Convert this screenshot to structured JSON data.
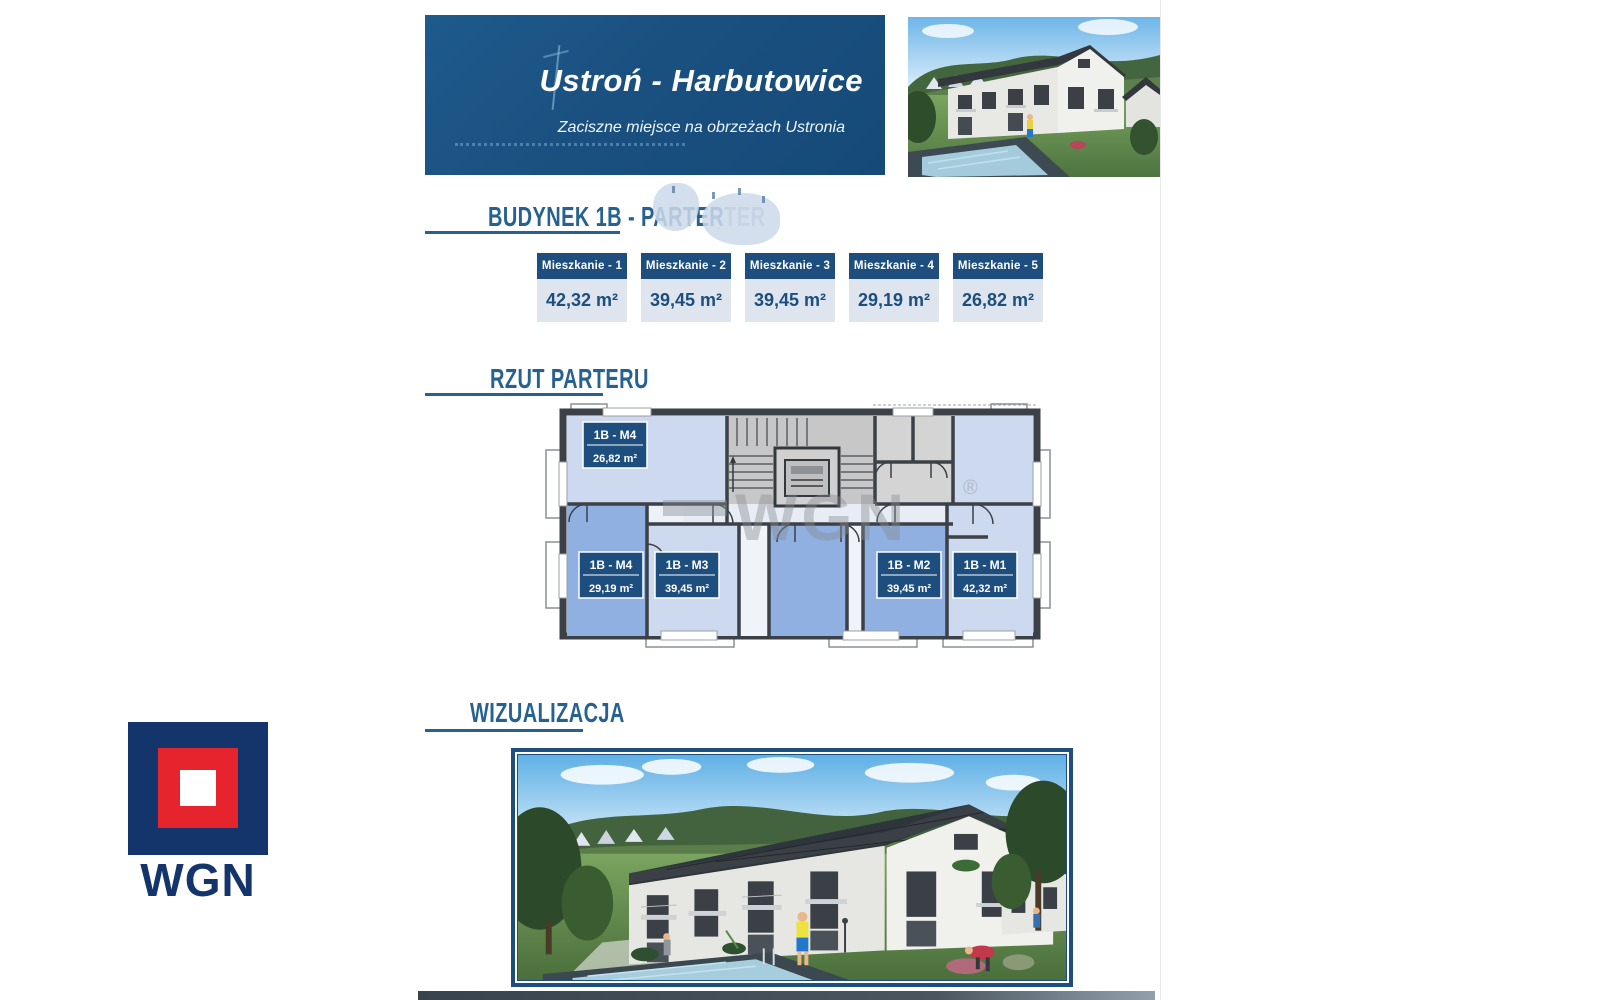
{
  "header": {
    "title": "Ustroń - Harbutowice",
    "subtitle": "Zaciszne miejsce na obrzeżach Ustronia"
  },
  "sections": {
    "apartments": "BUDYNEK 1B - PARTER",
    "apartments_ghost": "TER",
    "floorplan": "RZUT PARTERU",
    "visualization": "WIZUALIZACJA"
  },
  "apartments": [
    {
      "name": "Mieszkanie - 1",
      "area": "42,32 m²"
    },
    {
      "name": "Mieszkanie - 2",
      "area": "39,45 m²"
    },
    {
      "name": "Mieszkanie - 3",
      "area": "39,45 m²"
    },
    {
      "name": "Mieszkanie - 4",
      "area": "29,19 m²"
    },
    {
      "name": "Mieszkanie - 5",
      "area": "26,82 m²"
    }
  ],
  "floorplan": {
    "watermark": "WGN",
    "watermark_reg": "®",
    "rooms": [
      {
        "label": "1B - M4",
        "area": "26,82 m²"
      },
      {
        "label": "1B - M4",
        "area": "29,19 m²"
      },
      {
        "label": "1B - M3",
        "area": "39,45 m²"
      },
      {
        "label": "1B - M2",
        "area": "39,45 m²"
      },
      {
        "label": "1B - M1",
        "area": "42,32 m²"
      }
    ]
  },
  "logo": {
    "text": "WGN"
  },
  "colors": {
    "accent": "#1d4e7d",
    "banner": "#1a5080",
    "title_blue": "#26618f",
    "card_body": "#dfe5ef",
    "room_pale": "#cdd9ee",
    "room_medium": "#8fb0e0",
    "logo_navy": "#14356b",
    "logo_red": "#e6242d"
  }
}
